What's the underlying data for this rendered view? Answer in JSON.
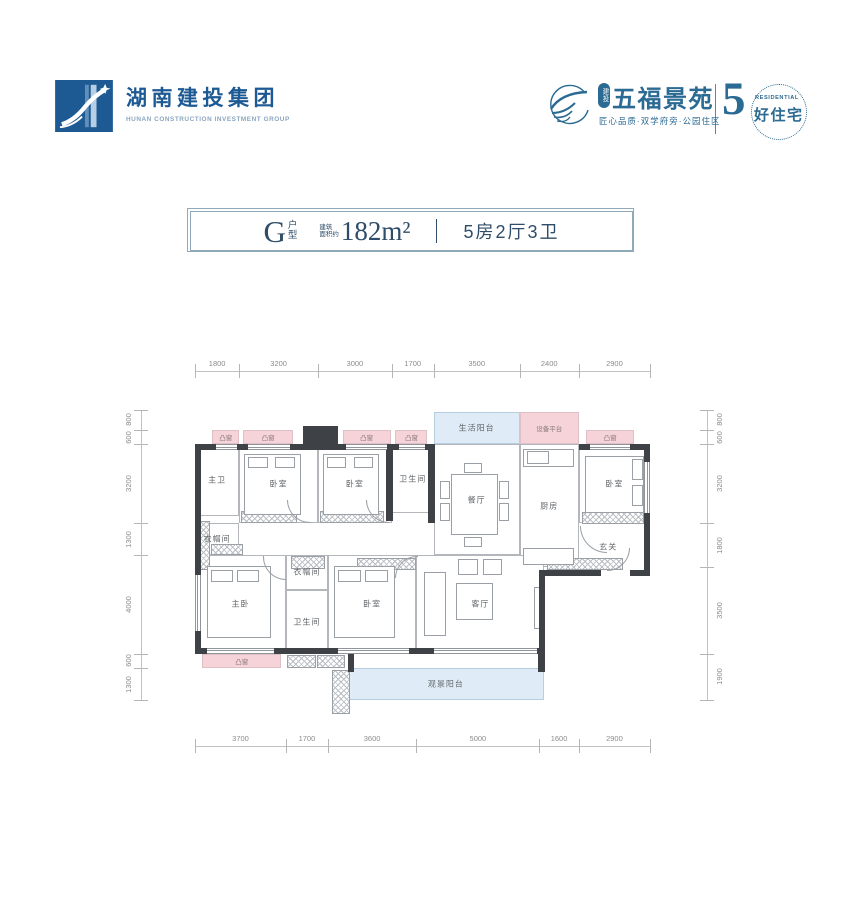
{
  "brand_left": {
    "name": "湖南建投集团",
    "name_en": "HUNAN CONSTRUCTION INVESTMENT GROUP"
  },
  "brand_right": {
    "badge": "建投",
    "name": "五福景苑",
    "tagline": "匠心品质·双学府旁·公园住区",
    "number": "5",
    "residential": "RESIDENTIAL",
    "slogan": "好住宅"
  },
  "title_bar": {
    "type_letter": "G",
    "type_label": "户型",
    "area_note_lines": [
      "建筑",
      "面积约"
    ],
    "area_value": "182m²",
    "layout_text": "5房2厅3卫"
  },
  "colors": {
    "brand_blue": "#1d5a94",
    "project_blue": "#2b6a93",
    "title_navy": "#2f4d68",
    "bay_pink": "#f5d3d8",
    "balcony_blue": "#dfecf7",
    "wall_dark": "#3e4247"
  },
  "floor_plan": {
    "dimensions": {
      "top": [
        "1800",
        "3200",
        "3000",
        "1700",
        "3500",
        "2400",
        "2900"
      ],
      "bottom": [
        "3700",
        "1700",
        "3600",
        "5000",
        "1600",
        "2900"
      ],
      "left": [
        "800",
        "600",
        "3200",
        "1300",
        "4000",
        "600",
        "1300"
      ],
      "right": [
        "800",
        "600",
        "3200",
        "1800",
        "3500",
        "1900"
      ]
    },
    "rooms": [
      {
        "id": "bay1",
        "label": "凸窗",
        "type": "bay"
      },
      {
        "id": "bay2",
        "label": "凸窗",
        "type": "bay"
      },
      {
        "id": "bay3",
        "label": "凸窗",
        "type": "bay"
      },
      {
        "id": "bay4",
        "label": "凸窗",
        "type": "bay"
      },
      {
        "id": "bay5",
        "label": "凸窗",
        "type": "bay"
      },
      {
        "id": "bay6",
        "label": "凸窗",
        "type": "bay"
      },
      {
        "id": "life_balcony",
        "label": "生活阳台",
        "type": "balcony"
      },
      {
        "id": "equip_platform",
        "label": "设备平台",
        "type": "bay"
      },
      {
        "id": "master_bath",
        "label": "主卫",
        "type": "room"
      },
      {
        "id": "bedroom1",
        "label": "卧室",
        "type": "room"
      },
      {
        "id": "bedroom2",
        "label": "卧室",
        "type": "room"
      },
      {
        "id": "bath2",
        "label": "卫生间",
        "type": "room"
      },
      {
        "id": "dining",
        "label": "餐厅",
        "type": "room"
      },
      {
        "id": "kitchen",
        "label": "厨房",
        "type": "room"
      },
      {
        "id": "bedroom3",
        "label": "卧室",
        "type": "room"
      },
      {
        "id": "cloak1",
        "label": "衣帽间",
        "type": "room"
      },
      {
        "id": "foyer",
        "label": "玄关",
        "type": "zone"
      },
      {
        "id": "master_bed",
        "label": "主卧",
        "type": "room"
      },
      {
        "id": "cloak2",
        "label": "衣帽间",
        "type": "room"
      },
      {
        "id": "bath3",
        "label": "卫生间",
        "type": "room"
      },
      {
        "id": "bedroom4",
        "label": "卧室",
        "type": "room"
      },
      {
        "id": "living",
        "label": "客厅",
        "type": "room"
      },
      {
        "id": "view_balcony",
        "label": "观景阳台",
        "type": "balcony"
      }
    ]
  }
}
